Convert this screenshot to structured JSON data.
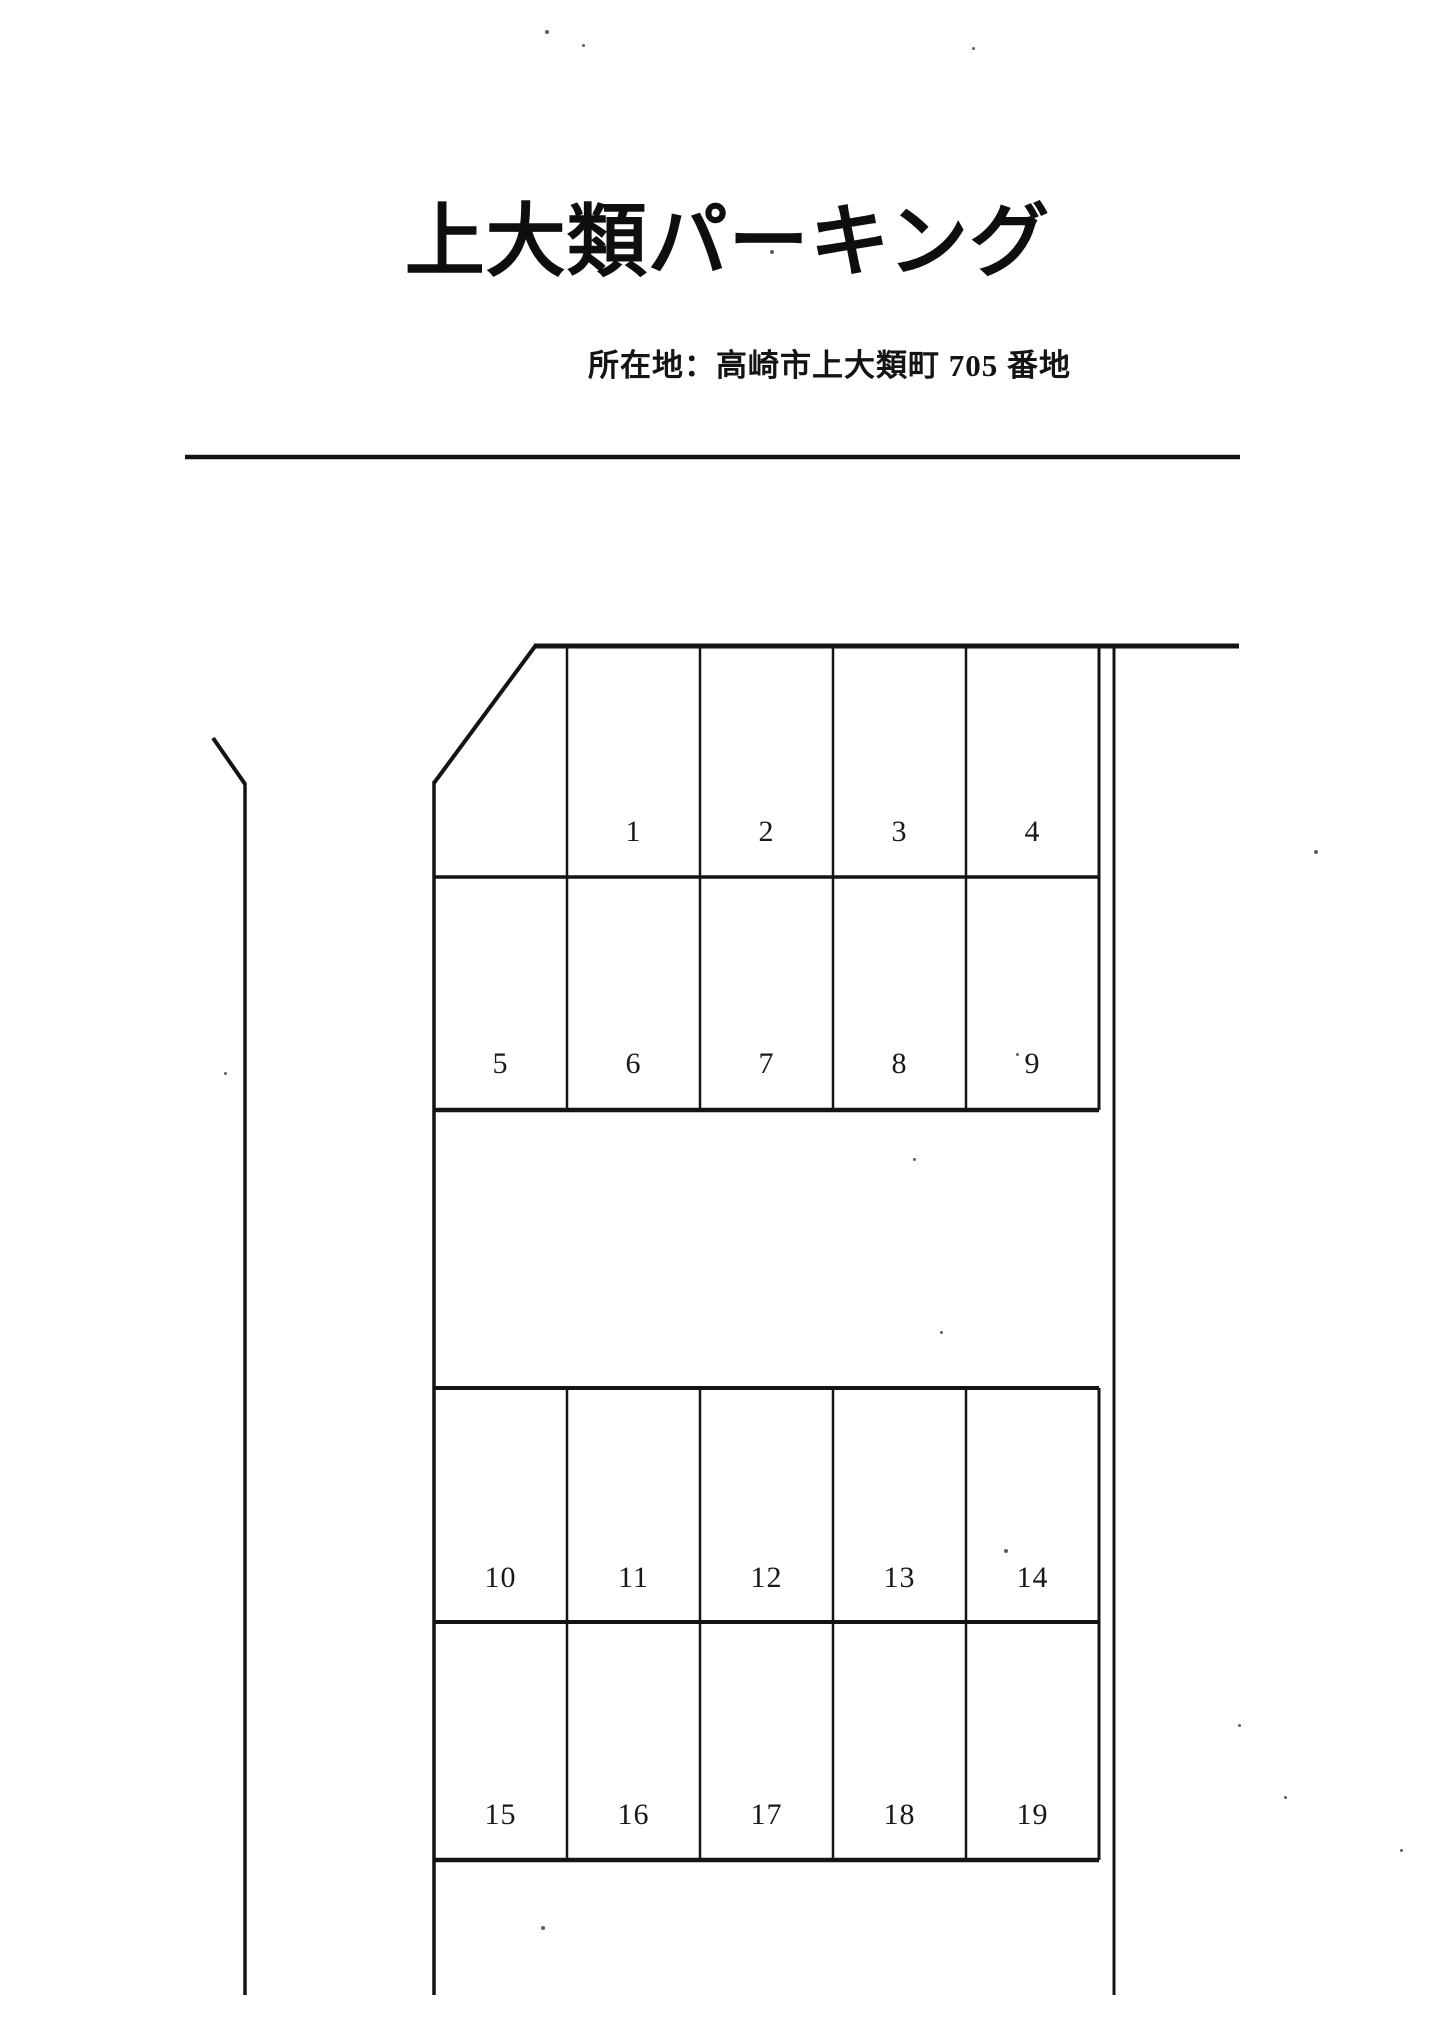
{
  "header": {
    "title": "上大類パーキング",
    "address": "所在地：高崎市上大類町 705 番地"
  },
  "diagram": {
    "description": "parking-lot-layout",
    "stalls": [
      "1",
      "2",
      "3",
      "4",
      "5",
      "6",
      "7",
      "8",
      "9",
      "10",
      "11",
      "12",
      "13",
      "14",
      "15",
      "16",
      "17",
      "18",
      "19"
    ]
  },
  "colors": {
    "ink": "#131313",
    "paper": "#ffffff"
  }
}
